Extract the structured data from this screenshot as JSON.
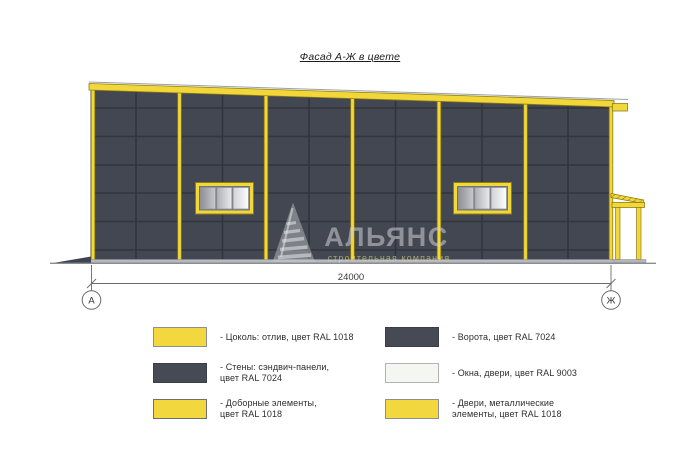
{
  "title": "Фасад А-Ж в цвете",
  "dimension": {
    "value": "24000",
    "axis_left": "А",
    "axis_right": "Ж"
  },
  "watermark": {
    "name": "АЛЬЯНС",
    "tagline": "строительная компания"
  },
  "legend": {
    "items_left": [
      {
        "name": "plinth",
        "color": "#f2d73e",
        "border": "#8f8f8f",
        "text": "- Цоколь: отлив, цвет RAL 1018"
      },
      {
        "name": "walls",
        "color": "#454a54",
        "border": "#3a3f47",
        "text": "- Стены: сэндвич-панели,\nцвет RAL 7024"
      },
      {
        "name": "trim",
        "color": "#f2d73e",
        "border": "#6e6e6e",
        "text": "- Доборные элементы,\nцвет RAL 1018"
      }
    ],
    "items_right": [
      {
        "name": "gates",
        "color": "#454a54",
        "border": "#3a3f47",
        "text": "- Ворота, цвет RAL 7024"
      },
      {
        "name": "windows",
        "color": "#f3f6f1",
        "border": "#b3b3b3",
        "text": "- Окна, двери, цвет RAL 9003"
      },
      {
        "name": "doors",
        "color": "#f2d73e",
        "border": "#8f8f8f",
        "text": "- Двери, металлические\nэлементы, цвет RAL 1018"
      }
    ]
  },
  "colors": {
    "accent_yellow": "#f2d73a",
    "wall_dark": "#434751",
    "seam_dark": "#33373e",
    "window_white": "#f3f6f1",
    "line_gray": "#6a6a6a"
  }
}
